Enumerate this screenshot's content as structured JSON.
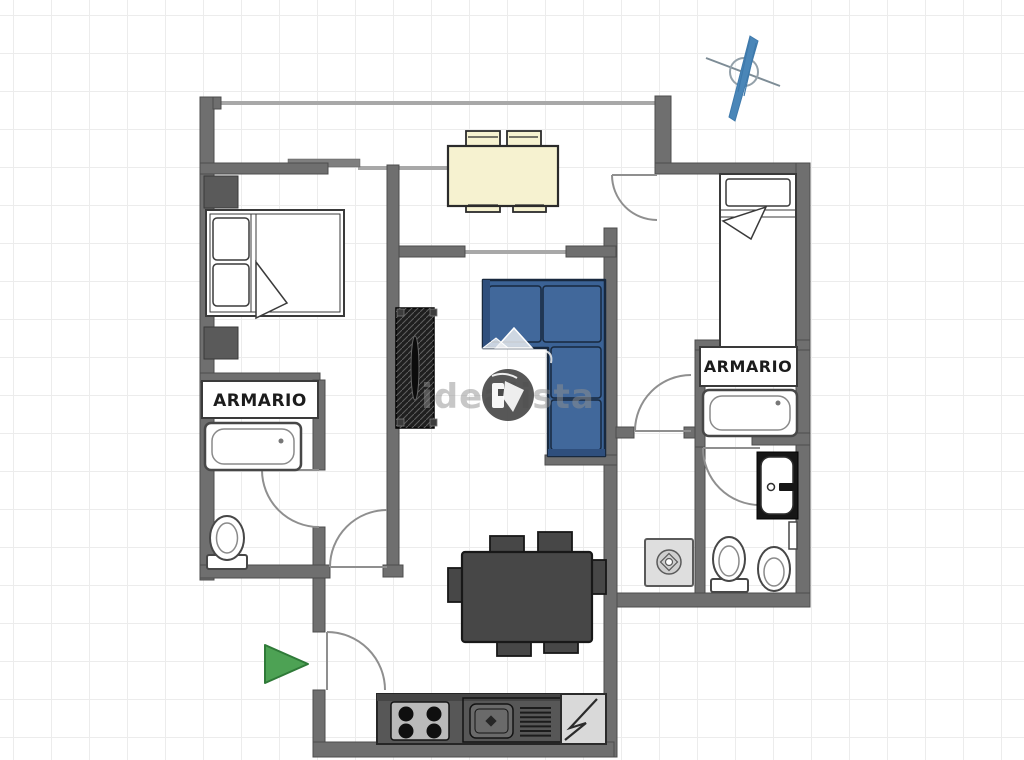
{
  "meta": {
    "title": "apartment-floor-plan",
    "width": 1024,
    "height": 760
  },
  "labels": {
    "armario_left": "ARMARIO",
    "armario_right": "ARMARIO"
  },
  "watermark": {
    "text": "idealista"
  },
  "colors": {
    "wall": "#6f6f6f",
    "wall_outline": "#4c4c4c",
    "door_arc": "#8f8f8f",
    "sofa": "#3b6295",
    "sofa_light": "#41689b",
    "sofa_dark": "#2f4f7d",
    "cream_furniture": "#f6f2d0",
    "dark_furniture": "#474747",
    "entrance_arrow": "#4da254",
    "compass_blue": "#4a86b8",
    "grid": "#ececec",
    "watermark_gray": "#8f8f8f"
  },
  "furniture": [
    "double-bed",
    "nightstand",
    "wardrobe-left",
    "bathtub-left",
    "toilet-left",
    "tv-sideboard",
    "corner-sofa",
    "dining-table-4-chairs",
    "dining-table-6-chairs",
    "single-bed",
    "wardrobe-right",
    "bathtub-right",
    "sink-vanity",
    "toilet-right",
    "bidet",
    "washing-machine",
    "stove",
    "kitchen-sink",
    "refrigerator"
  ]
}
